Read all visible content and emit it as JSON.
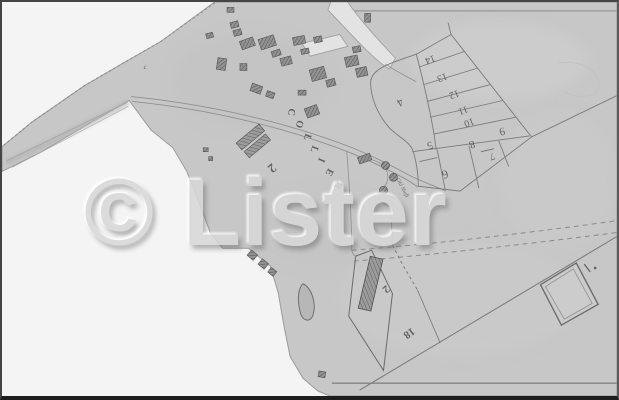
{
  "watermark": {
    "symbol": "©",
    "name": "Lister"
  },
  "labels": {
    "street_name": "COLLIER",
    "parcel_numbers": [
      "14",
      "13",
      "12",
      "11",
      "10",
      "9",
      "8",
      "7",
      "5",
      "6",
      "4"
    ],
    "plot_numbers": [
      "2",
      "2",
      "18"
    ],
    "shaft_note": "Old Shaft",
    "edge_mark": "c"
  },
  "colors": {
    "paper": "#c7c7c7",
    "margin": "#f4f4f4",
    "ink": "#4f4f4f",
    "building_line": "#555555",
    "watermark_text": "#d8d8d8"
  }
}
